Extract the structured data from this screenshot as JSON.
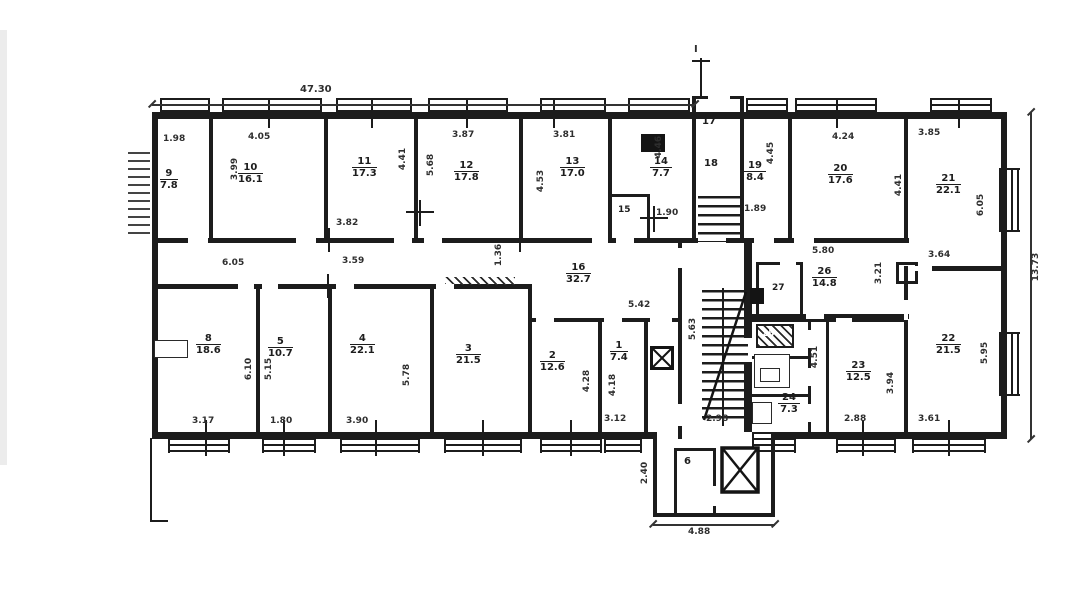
{
  "plan": {
    "type": "apartment-floor-plan",
    "section_mark": "I",
    "rooms": {
      "r1": {
        "number": "1",
        "area": "7.4"
      },
      "r2": {
        "number": "2",
        "area": "12.6"
      },
      "r3": {
        "number": "3",
        "area": "21.5"
      },
      "r4": {
        "number": "4",
        "area": "22.1"
      },
      "r5": {
        "number": "5",
        "area": "10.7"
      },
      "r6": {
        "number": "6",
        "area": ""
      },
      "r8": {
        "number": "8",
        "area": "18.6"
      },
      "r9": {
        "number": "9",
        "area": "7.8"
      },
      "r10": {
        "number": "10",
        "area": "16.1"
      },
      "r11": {
        "number": "11",
        "area": "17.3"
      },
      "r12": {
        "number": "12",
        "area": "17.8"
      },
      "r13": {
        "number": "13",
        "area": "17.0"
      },
      "r14": {
        "number": "14",
        "area": "7.7"
      },
      "r15": {
        "number": "15",
        "area": ""
      },
      "r16": {
        "number": "16",
        "area": "32.7"
      },
      "r17": {
        "number": "17",
        "area": ""
      },
      "r18": {
        "number": "18",
        "area": ""
      },
      "r19": {
        "number": "19",
        "area": "8.4"
      },
      "r20": {
        "number": "20",
        "area": "17.6"
      },
      "r21": {
        "number": "21",
        "area": "22.1"
      },
      "r22": {
        "number": "22",
        "area": "21.5"
      },
      "r23": {
        "number": "23",
        "area": "12.5"
      },
      "r24": {
        "number": "24",
        "area": "7.3"
      },
      "r25": {
        "number": "25",
        "area": ""
      },
      "r26": {
        "number": "26",
        "area": "14.8"
      },
      "r27": {
        "number": "27",
        "area": ""
      }
    },
    "dims": {
      "d4730": "47.30",
      "d1373": "13.73",
      "d198": "1.98",
      "d405": "4.05",
      "d399": "3.99",
      "d382": "3.82",
      "d441a": "4.41",
      "d387": "3.87",
      "d568": "5.68",
      "d453": "4.53",
      "d381": "3.81",
      "d446": "4.46",
      "d190": "1.90",
      "d445": "4.45",
      "d189": "1.89",
      "d424": "4.24",
      "d441b": "4.41",
      "d385": "3.85",
      "d605r21": "6.05",
      "d364": "3.64",
      "d605c": "6.05",
      "d359": "3.59",
      "d136": "1.36",
      "d542": "5.42",
      "d563": "5.63",
      "d580": "5.80",
      "d321": "3.21",
      "d451": "4.51",
      "d610": "6.10",
      "d515": "5.15",
      "d317": "3.17",
      "d180": "1.80",
      "d390": "3.90",
      "d578": "5.78",
      "d428": "4.28",
      "d418": "4.18",
      "d312": "3.12",
      "d298": "2.98",
      "d288": "2.88",
      "d394": "3.94",
      "d361": "3.61",
      "d595": "5.95",
      "d240": "2.40",
      "d488": "4.88"
    }
  }
}
